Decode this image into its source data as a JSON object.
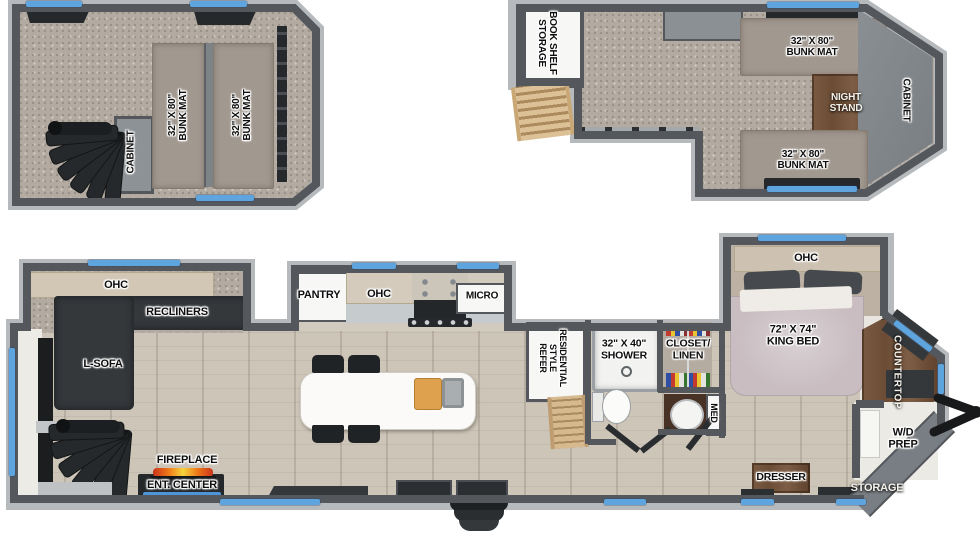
{
  "title": "Travel trailer two-level floor plan",
  "colors": {
    "wall": "#54585c",
    "wall_rim": "#b7babc",
    "window_blue": "#5ea4de",
    "carpet": "#b3aaa1",
    "plank_floor": "#cdc5b8",
    "wood_furniture": "#6b4c35",
    "flame_orange": "#f07818"
  },
  "loft_left": {
    "cabinet": "CABINET",
    "bunk_left": "32\" X 80\"\nBUNK MAT",
    "bunk_right": "32\" X 80\"\nBUNK MAT"
  },
  "loft_right": {
    "book_shelf": "BOOK SHELF\nSTORAGE",
    "bunk_top": "32\" X 80\"\nBUNK MAT",
    "night_stand": "NIGHT\nSTAND",
    "cabinet": "CABINET",
    "bunk_bottom": "32\" X 80\"\nBUNK MAT"
  },
  "main": {
    "ohc_living": "OHC",
    "recliners": "RECLINERS",
    "l_sofa": "L-SOFA",
    "fireplace": "FIREPLACE",
    "ent_center": "ENT. CENTER",
    "pantry": "PANTRY",
    "ohc_kitchen": "OHC",
    "micro": "MICRO",
    "refer": "RESIDENTIAL\nSTYLE\nREFER",
    "shower": "32\" X 40\"\nSHOWER",
    "closet": "CLOSET/\nLINEN",
    "med": "MED",
    "ohc_bedroom": "OHC",
    "king_bed": "72\" X 74\"\nKING BED",
    "countertop": "COUNTERTOP",
    "wd_prep": "W/D\nPREP",
    "storage": "STORAGE",
    "dresser": "DRESSER"
  }
}
